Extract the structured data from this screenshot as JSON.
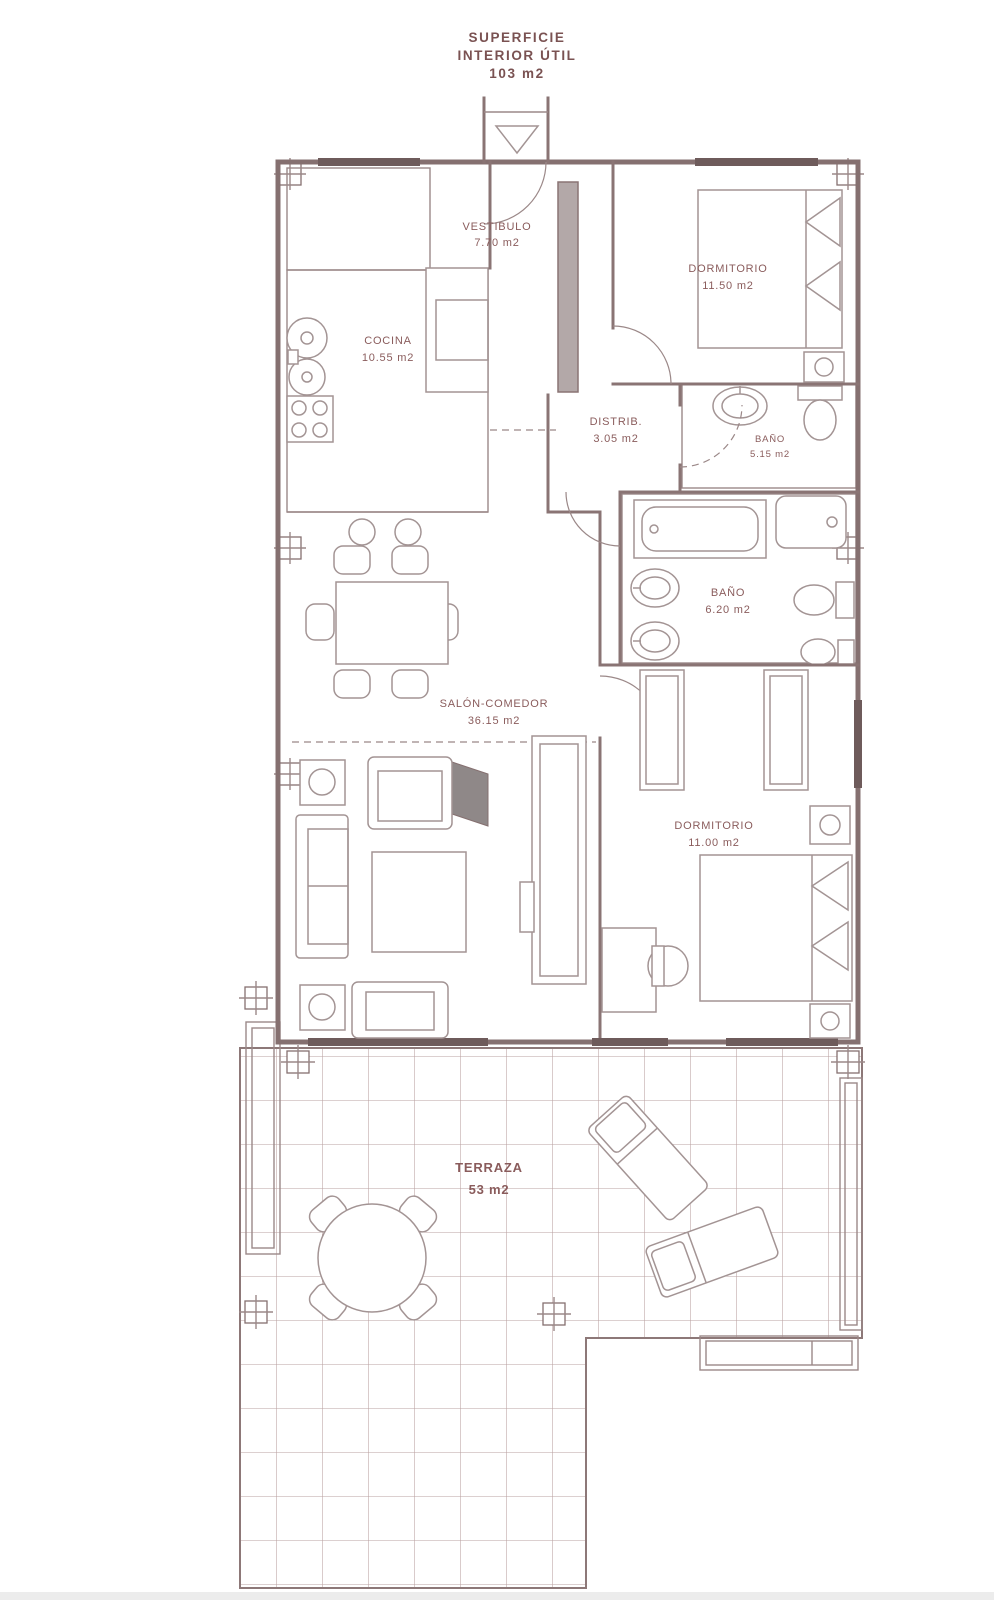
{
  "header": {
    "title_line1": "SUPERFICIE",
    "title_line2": "INTERIOR ÚTIL",
    "title_line3": "103 m2"
  },
  "rooms": {
    "vestibulo": {
      "name": "VESTIBULO",
      "area": "7.70 m2"
    },
    "dormitorio1": {
      "name": "DORMITORIO",
      "area": "11.50 m2"
    },
    "cocina": {
      "name": "COCINA",
      "area": "10.55 m2"
    },
    "distribuidor": {
      "name": "DISTRIB.",
      "area": "3.05 m2"
    },
    "bano1": {
      "name": "BAÑO",
      "area": "5.15 m2"
    },
    "bano2": {
      "name": "BAÑO",
      "area": "6.20 m2"
    },
    "salon": {
      "name": "SALÓN-COMEDOR",
      "area": "36.15 m2"
    },
    "dormitorio2": {
      "name": "DORMITORIO",
      "area": "11.00 m2"
    },
    "terraza": {
      "name": "TERRAZA",
      "area": "53 m2"
    }
  },
  "icons": {
    "entrance": "entrance-arrow-down"
  },
  "colors": {
    "walls": "#857070",
    "furniture": "#a39494",
    "tiles": "#c0a6a6",
    "terrace_grid": "#b9a0a0",
    "text": "#8a5c5c",
    "window": "#6e5b5b",
    "background": "#ffffff"
  }
}
